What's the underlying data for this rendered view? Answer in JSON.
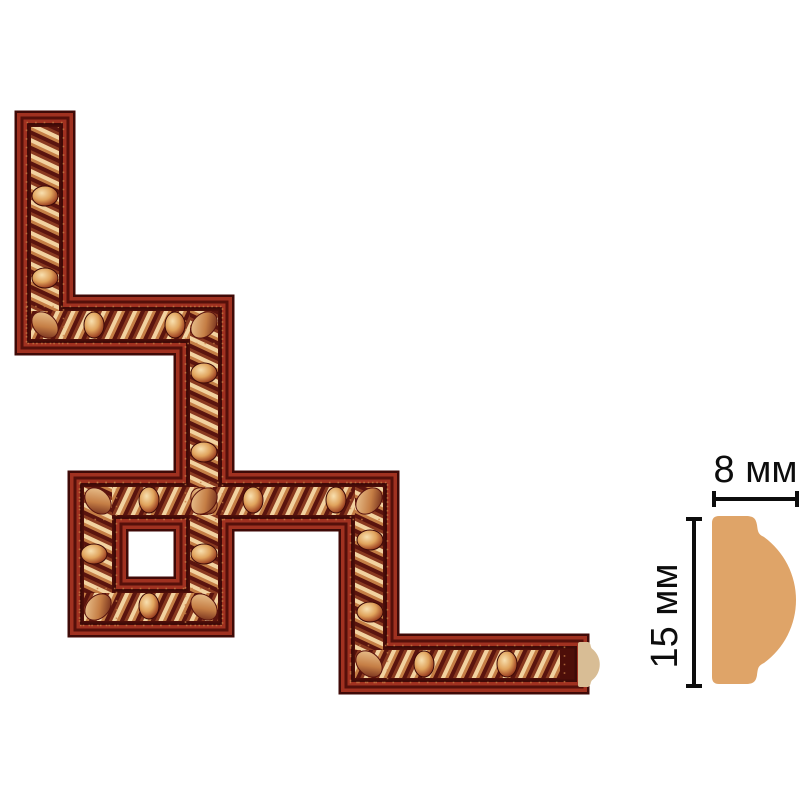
{
  "annotations": {
    "width_label": "8 мм",
    "height_label": "15 мм"
  },
  "colors": {
    "bg": "#ffffff",
    "molding-red": "#a03120",
    "molding-dark": "#3f0a07",
    "molding-field": "#4d0e09",
    "molding-line": "#55100a",
    "rope-cream": "#f2d2a0",
    "rope-copper": "#c57e45",
    "rope-brown": "#8a3a20",
    "rope-dark": "#5a140e",
    "bead-light": "#f8e0b0",
    "bead-mid": "#e0a35c",
    "bead-deep": "#a8502a",
    "bead-dark": "#5f160c",
    "profile-tan": "#dfa468",
    "cap-tan": "#d8bd95",
    "annotation": "#0d0d0d"
  }
}
